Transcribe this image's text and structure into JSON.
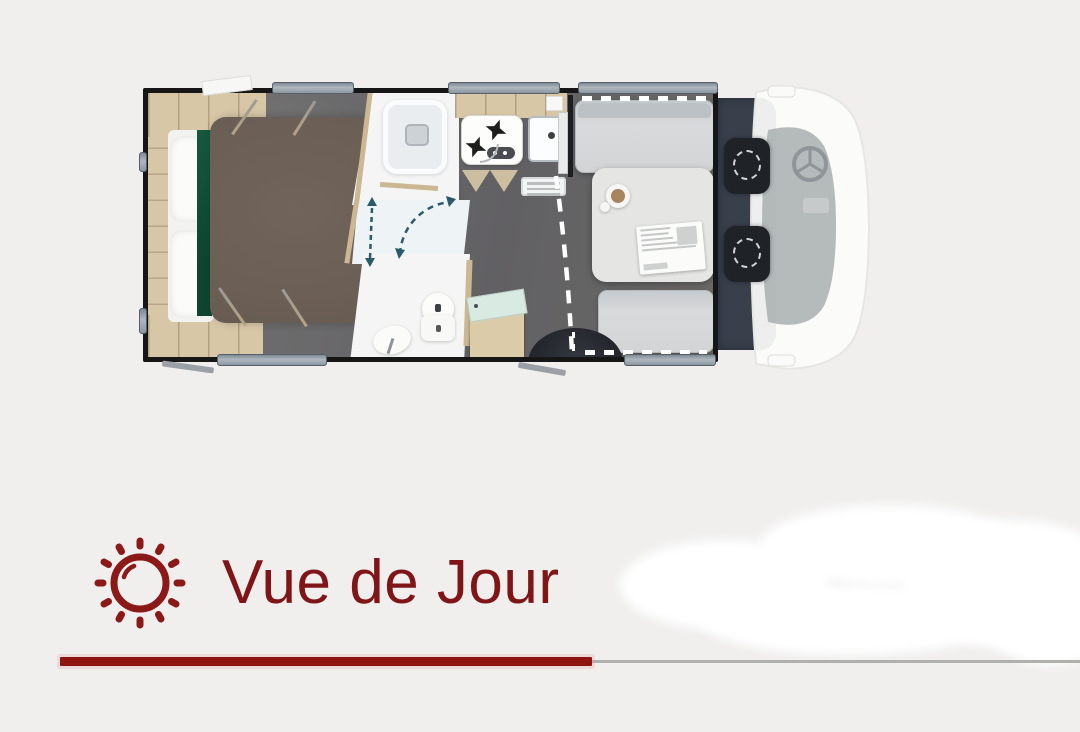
{
  "page": {
    "background": "#f0efee"
  },
  "footer": {
    "label": "Vue de Jour",
    "accent_color": "#8b1717",
    "divider_gray": "#b0b0ae",
    "icon": "sun-icon"
  },
  "floorplan": {
    "zones": [
      "bedroom",
      "wardrobe",
      "shower-room",
      "toilet-room",
      "kitchen",
      "dinette",
      "entry-step",
      "cab"
    ],
    "colors": {
      "wall": "#161616",
      "floor": "#68676a",
      "wood": "#d8c7a7",
      "bed_duvet": "#6d6057",
      "green_blanket": "#14543c",
      "window_bar": "#8d97a0",
      "cab_floor": "#39404c",
      "swivel_seat": "#1f2327",
      "mint_counter": "#d9eae3",
      "walkway_dash": "#ffffff",
      "door_swing_dash": "#2b5a68"
    }
  }
}
